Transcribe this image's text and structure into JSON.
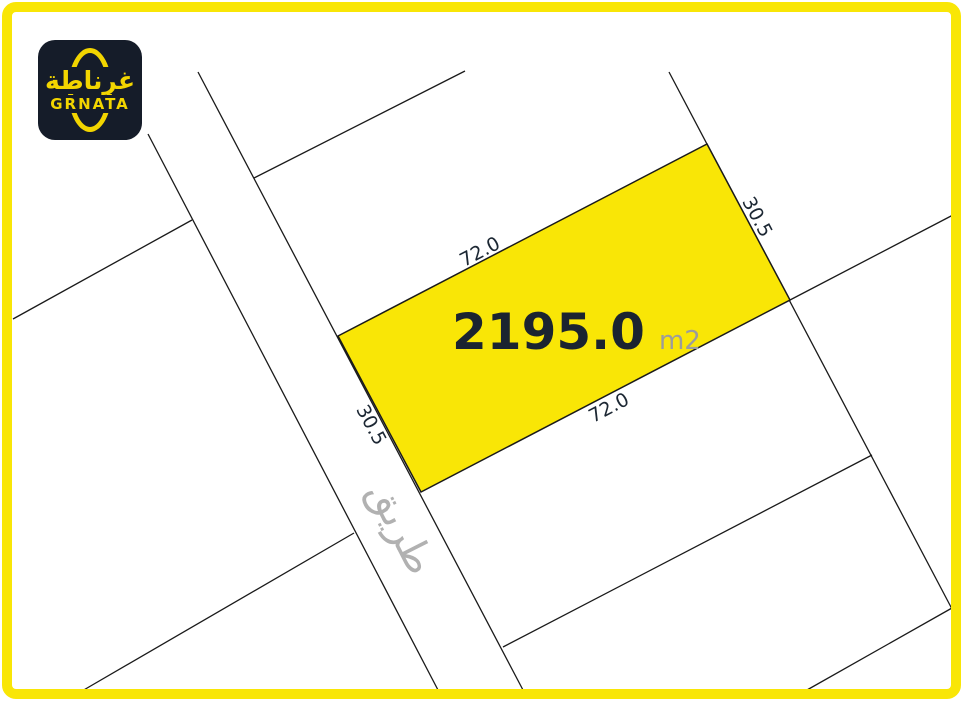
{
  "brand": {
    "logo_arabic": "غرناطة",
    "logo_latin": "GRNATA"
  },
  "parcel": {
    "area_value": "2195.0",
    "area_unit": "m2",
    "dim_top": "72.0",
    "dim_bottom": "72.0",
    "dim_left": "30.5",
    "dim_right": "30.5"
  },
  "road": {
    "label": "طريق"
  },
  "colors": {
    "accent_yellow": "#F9E606",
    "logo_yellow": "#F2D500",
    "logo_bg": "#151C29",
    "line": "#1A1A1A",
    "area_text": "#1B2430",
    "unit_gray": "#9C9C9C",
    "road_gray": "#B1B1B1",
    "dim_text": "#1C2733"
  }
}
